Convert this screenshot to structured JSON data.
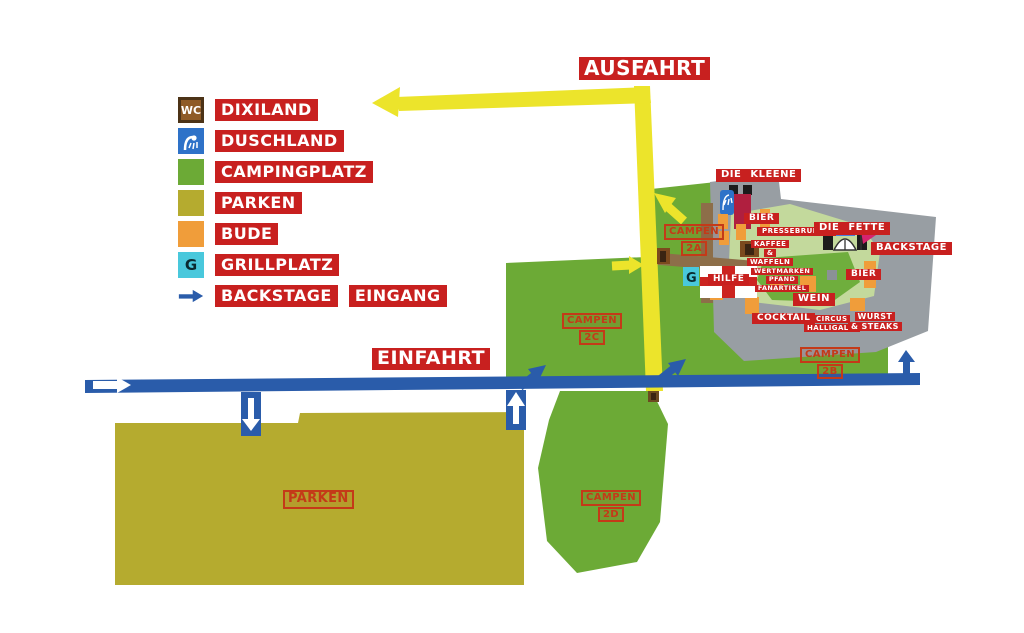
{
  "legend": {
    "items": [
      {
        "id": "dixiland",
        "icon": "wc-icon",
        "icon_text": "WC",
        "label": "DIXILAND"
      },
      {
        "id": "duschland",
        "icon": "shower-icon",
        "label": "DUSCHLAND"
      },
      {
        "id": "campingplatz",
        "icon": "camping-swatch",
        "label": "CAMPINGPLATZ"
      },
      {
        "id": "parken",
        "icon": "parken-swatch",
        "label": "PARKEN"
      },
      {
        "id": "bude",
        "icon": "bude-swatch",
        "label": "BUDE"
      },
      {
        "id": "grillplatz",
        "icon": "grill-swatch",
        "icon_text": "G",
        "label": "GRILLPLATZ"
      },
      {
        "id": "backstage-eingang",
        "icon": "blue-arrow-icon",
        "label": "BACKSTAGE",
        "label2": "EINGANG"
      }
    ]
  },
  "roads": {
    "ausfahrt_label": "AUSFAHRT",
    "einfahrt_label": "EINFAHRT"
  },
  "areas": {
    "campen_2a": {
      "name": "CAMPEN",
      "code": "2A"
    },
    "campen_2b": {
      "name": "CAMPEN",
      "code": "2B"
    },
    "campen_2c": {
      "name": "CAMPEN",
      "code": "2C"
    },
    "campen_2d": {
      "name": "CAMPEN",
      "code": "2D"
    },
    "parken": {
      "name": "PARKEN"
    }
  },
  "stalls": {
    "die_kleene": "DIE KLEENE",
    "bier_left": "BIER",
    "pressebrunch": "PRESSEBRUNCH",
    "kaffee_waffeln": {
      "line1": "KAFFEE",
      "line2": "&",
      "line3": "WAFFELN"
    },
    "die_fette": "DIE FETTE",
    "backstage": "BACKSTAGE",
    "bier_right": "BIER",
    "wertmarken": {
      "line1": "WERTMARKEN",
      "line2": "PFAND",
      "line3": "FANARTIKEL"
    },
    "wein": "WEIN",
    "cocktail": "COCKTAIL",
    "circus": {
      "line1": "CIRCUS",
      "line2": "HALLIGALLI"
    },
    "wurst_steaks": {
      "line1": "WURST",
      "line2": "& STEAKS"
    },
    "hilfe": "HILFE"
  },
  "map_icons": {
    "grill_letter": "G"
  },
  "colors": {
    "red_label_bg": "#c8201f",
    "outline_label_red": "#c43a18",
    "camping_green": "#6caa36",
    "field_light_green": "#c3d99c",
    "infield_green": "#6fae3d",
    "parken_olive": "#b5ab2f",
    "bude_orange": "#f09d3a",
    "grill_cyan": "#49c8dc",
    "wc_brown": "#8f5b27",
    "shower_blue": "#2e72c8",
    "road_yellow": "#ece42b",
    "road_blue": "#2a5caa",
    "ground_gray": "#989ea3",
    "stage_crimson": "#b01f3f",
    "flag_pink": "#d6246e",
    "path_brown": "#8d6e49"
  }
}
